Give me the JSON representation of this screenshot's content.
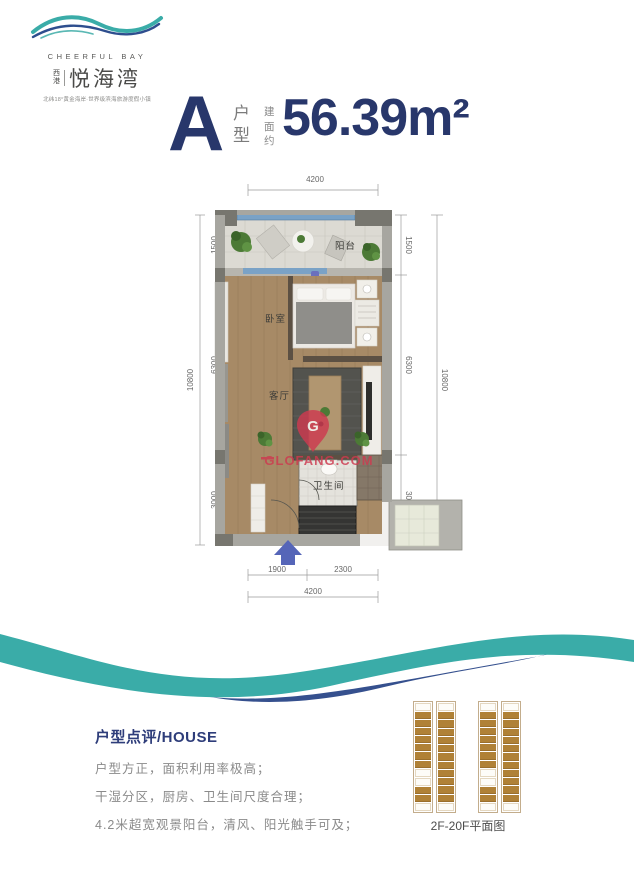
{
  "brand": {
    "name_en": "CHEERFUL BAY",
    "prefix_top": "西",
    "prefix_bottom": "港",
    "name_cn": "悦海湾",
    "tagline": "北纬18°黄金海岸·世界级滨海旅游度假小镇"
  },
  "title": {
    "unit": "A",
    "unit_label_top": "户",
    "unit_label_bottom": "型",
    "area_prefix_1": "建",
    "area_prefix_2": "面",
    "area_prefix_3": "约",
    "area": "56.39m²"
  },
  "plan": {
    "labels": {
      "balcony": "阳台",
      "bedroom": "卧室",
      "living": "客厅",
      "bathroom": "卫生间"
    },
    "watermark": "GLOFANG.COM",
    "watermark_letter": "G",
    "dims": {
      "top_total": "4200",
      "left_total": "10800",
      "left_seg_1": "1500",
      "left_seg_2": "6300",
      "left_seg_3": "3000",
      "right_total": "10800",
      "right_seg_1": "1500",
      "right_seg_2": "6300",
      "right_seg_3": "3000",
      "bottom_seg_1": "1900",
      "bottom_seg_2": "2300",
      "bottom_total": "4200"
    }
  },
  "review": {
    "heading": "户型点评/HOUSE",
    "line_1": "户型方正，面积利用率极高；",
    "line_2": "干湿分区，厨房、卫生间尺度合理；",
    "line_3": "4.2米超宽观景阳台，清风、阳光触手可及；"
  },
  "floorplate": {
    "caption": "2F-20F平面图",
    "strips": [
      {
        "cells": [
          "c",
          "u",
          "u",
          "u",
          "u",
          "u",
          "u",
          "u",
          "c",
          "c",
          "u",
          "u",
          "c"
        ]
      },
      {
        "cells": [
          "c",
          "u",
          "u",
          "u",
          "u",
          "u",
          "u",
          "u",
          "u",
          "u",
          "u",
          "u",
          "c"
        ]
      }
    ]
  },
  "colors": {
    "accent_navy": "#28376b",
    "wave_teal": "#3aaca8",
    "wave_navy": "#35508e",
    "watermark_red": "#ce3a50",
    "unit_cell_tan": "#b08136"
  }
}
